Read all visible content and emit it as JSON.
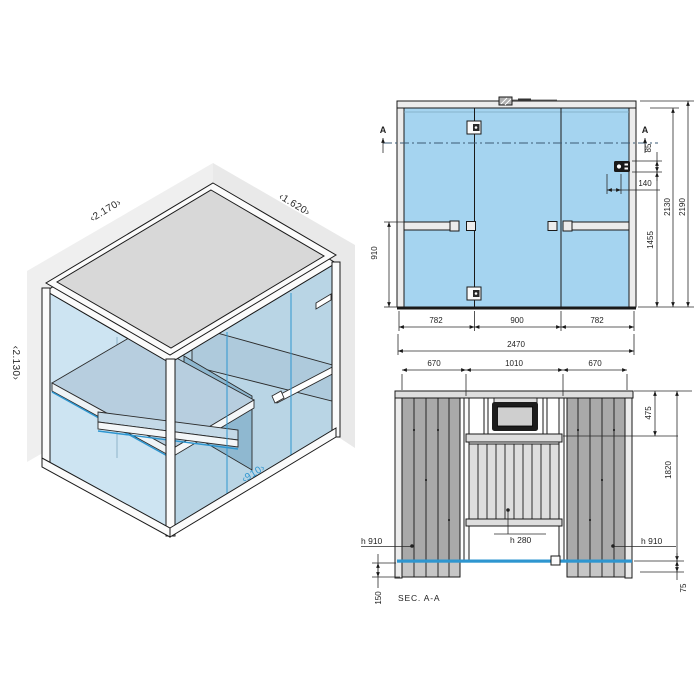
{
  "isometric": {
    "labels": {
      "width": "‹2.170›",
      "depth": "‹1.620›",
      "height": "‹2.130›",
      "door": "‹910›"
    }
  },
  "front_elevation": {
    "marker": "A",
    "dims": {
      "d85": "85",
      "d140": "140",
      "d2130": "2130",
      "d2190": "2190",
      "d1455": "1455",
      "d910": "910",
      "d782a": "782",
      "d900": "900",
      "d782b": "782",
      "d2470": "2470"
    }
  },
  "section_view": {
    "label": "SEC.  A-A",
    "dims": {
      "d670a": "670",
      "d1010": "1010",
      "d670b": "670",
      "d475": "475",
      "d1820": "1820",
      "h910a": "h 910",
      "h280": "h 280",
      "h910b": "h 910",
      "d150": "150",
      "d75": "75"
    }
  },
  "colors": {
    "glass": "#a5d4f0",
    "glass_iso_left": "#cde4f2",
    "glass_iso_right": "#b9d5e5",
    "roof": "#d8d8d8",
    "panel_dark": "#a9a9a9",
    "panel_light": "#dedede",
    "accent": "#2e96d0"
  }
}
